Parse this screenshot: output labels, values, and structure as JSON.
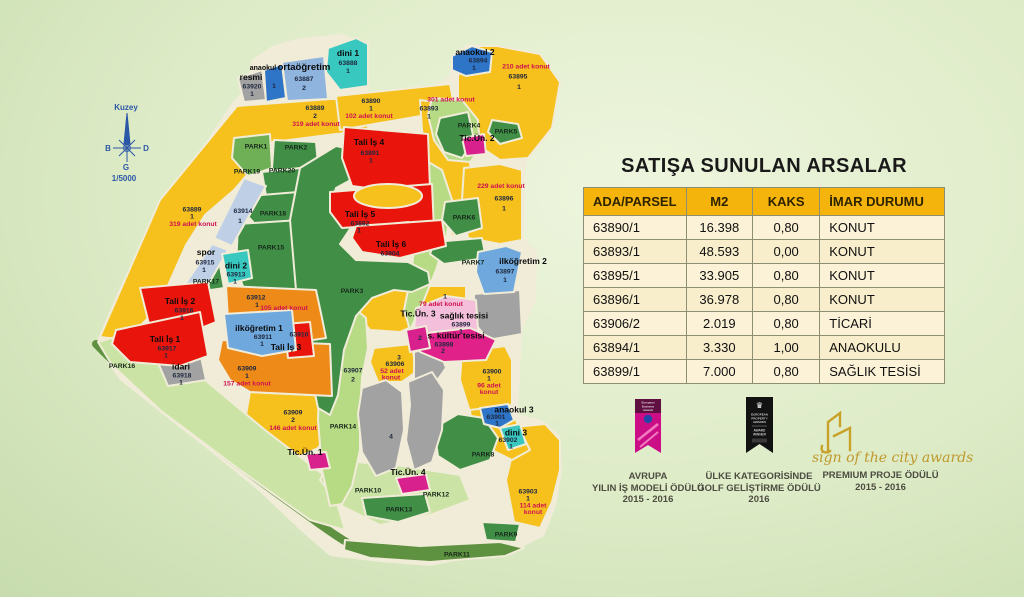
{
  "compass": {
    "north": "Kuzey",
    "west": "B",
    "east": "D",
    "south": "G",
    "scale": "1/5000"
  },
  "table": {
    "title": "SATIŞA SUNULAN ARSALAR",
    "headers": [
      "ADA/PARSEL",
      "M2",
      "KAKS",
      "İMAR DURUMU"
    ],
    "rows": [
      [
        "63890/1",
        "16.398",
        "0,80",
        "KONUT"
      ],
      [
        "63893/1",
        "48.593",
        "0,00",
        "KONUT"
      ],
      [
        "63895/1",
        "33.905",
        "0,80",
        "KONUT"
      ],
      [
        "63896/1",
        "36.978",
        "0,80",
        "KONUT"
      ],
      [
        "63906/2",
        "2.019",
        "0,80",
        "TİCARİ"
      ],
      [
        "63894/1",
        "3.330",
        "1,00",
        "ANAOKULU"
      ],
      [
        "63899/1",
        "7.000",
        "0,80",
        "SAĞLIK TESİSİ"
      ]
    ]
  },
  "awards": {
    "a1": {
      "ribbon_lines": [
        "European",
        "Business",
        "Awards"
      ],
      "caption": [
        "AVRUPA",
        "YILIN İŞ MODELİ ÖDÜLÜ",
        "2015 - 2016"
      ]
    },
    "a2": {
      "ribbon_lines": [
        "EUROPEAN",
        "PROPERTY",
        "AWARDS"
      ],
      "winner": [
        "AWARD",
        "WINNER"
      ],
      "caption": [
        "ÜLKE KATEGORİSİNDE",
        "GOLF GELİŞTİRME ÖDÜLÜ",
        "2016"
      ]
    },
    "a3": {
      "logo_text": "sign of the city awards",
      "caption": [
        "PREMIUM PROJE ÖDÜLÜ",
        "2015 - 2016"
      ]
    }
  },
  "map": {
    "parks": {
      "p1": "PARK1",
      "p2": "PARK2",
      "p3": "PARK3",
      "p4": "PARK4",
      "p5": "PARK5",
      "p6": "PARK6",
      "p7": "PARK7",
      "p8": "PARK8",
      "p9": "PARK9",
      "p10": "PARK10",
      "p11": "PARK11",
      "p12": "PARK12",
      "p13": "PARK13",
      "p14": "PARK14",
      "p15": "PARK15",
      "p16": "PARK16",
      "p17": "PARK17",
      "p18": "PARK18",
      "p19": "PARK19",
      "p20": "PARK20"
    },
    "parcels": {
      "resmi": {
        "t": "resmi",
        "n1": "63920",
        "n2": "1"
      },
      "anaokul1": {
        "t": "anaokul",
        "n2": "1"
      },
      "ortaogretim": {
        "t": "ortaöğretim",
        "n1": "63887",
        "n2": "2"
      },
      "dini1": {
        "t": "dini 1",
        "n1": "63888",
        "n2": "1"
      },
      "b63889_2": {
        "n1": "63889",
        "n2": "2",
        "c": "319 adet konut"
      },
      "b63890": {
        "n1": "63890",
        "n2": "1",
        "c": "102 adet konut"
      },
      "b63893": {
        "c": "301 adet konut",
        "n1": "63893",
        "n2": "1"
      },
      "anaokul2": {
        "t": "anaokul 2",
        "n1": "63894",
        "n2": "1"
      },
      "b63895": {
        "c": "210 adet konut",
        "n1": "63895",
        "n2": "1"
      },
      "talis4": {
        "t": "Tali İş 4",
        "n1": "63891",
        "n2": "1"
      },
      "b63896": {
        "c": "229 adet konut",
        "n1": "63896",
        "n2": "1"
      },
      "b63889_1": {
        "n1": "63889",
        "n2": "1",
        "c": "319 adet konut"
      },
      "b63914": {
        "n1": "63914",
        "n2": "1"
      },
      "spor": {
        "t": "spor",
        "n1": "63915",
        "n2": "1"
      },
      "dini2": {
        "t": "dini 2",
        "n1": "63913",
        "n2": "1"
      },
      "talis2": {
        "t": "Tali İş 2",
        "n1": "63916",
        "n2": "1"
      },
      "talis1": {
        "t": "Tali İş 1",
        "n1": "63917",
        "n2": "1"
      },
      "idari": {
        "t": "idari",
        "n1": "63918",
        "n2": "1"
      },
      "b63912": {
        "n1": "63912",
        "n2": "1",
        "c": "105 adet konut"
      },
      "ilkogretim1": {
        "t": "ilköğretim 1",
        "n1": "63911",
        "n2": "1"
      },
      "talis3": {
        "t": "Tali İş 3",
        "n1": "63910"
      },
      "b63909_1": {
        "n1": "63909",
        "n2": "1",
        "c": "157 adet konut"
      },
      "b63909_2": {
        "n1": "63909",
        "n2": "2",
        "c": "146 adet konut"
      },
      "talis5": {
        "t": "Tali İş 5",
        "n1": "63892",
        "n2": "1"
      },
      "talis6": {
        "t": "Tali İş 6",
        "n1": "63904"
      },
      "ilkogretim2": {
        "t": "ilköğretim 2",
        "n1": "63897",
        "n2": "1"
      },
      "b79": {
        "n2": "1",
        "c": "79 adet konut"
      },
      "ticun3": {
        "t": "Tic.Ün. 3",
        "n2": "2"
      },
      "saglik": {
        "t": "sağlık tesisi",
        "n1": "63899",
        "n2": "1"
      },
      "kultur": {
        "t": "s. kültür tesisi",
        "n1": "63898",
        "n2": "2"
      },
      "b63906": {
        "n2": "3",
        "n1": "63906",
        "c": "52 adet",
        "c2": "konut"
      },
      "b63900": {
        "n1": "63900",
        "n2": "1",
        "c": "96 adet",
        "c2": "konut"
      },
      "anaokul3": {
        "t": "anaokul 3",
        "n1": "63901",
        "n2": "1"
      },
      "dini3": {
        "t": "dini 3",
        "n1": "63902",
        "n2": "1"
      },
      "b63903": {
        "n1": "63903",
        "n2": "1",
        "c": "114 adet",
        "c2": "konut"
      },
      "ticun1": {
        "t": "Tic.Ün. 1"
      },
      "ticun2": {
        "t": "Tic.Ün. 2"
      },
      "ticun4": {
        "t": "Tic.Ün. 4"
      },
      "b63907": {
        "n1": "63907",
        "n2": "2"
      },
      "gray4": {
        "n2": "4"
      }
    }
  }
}
